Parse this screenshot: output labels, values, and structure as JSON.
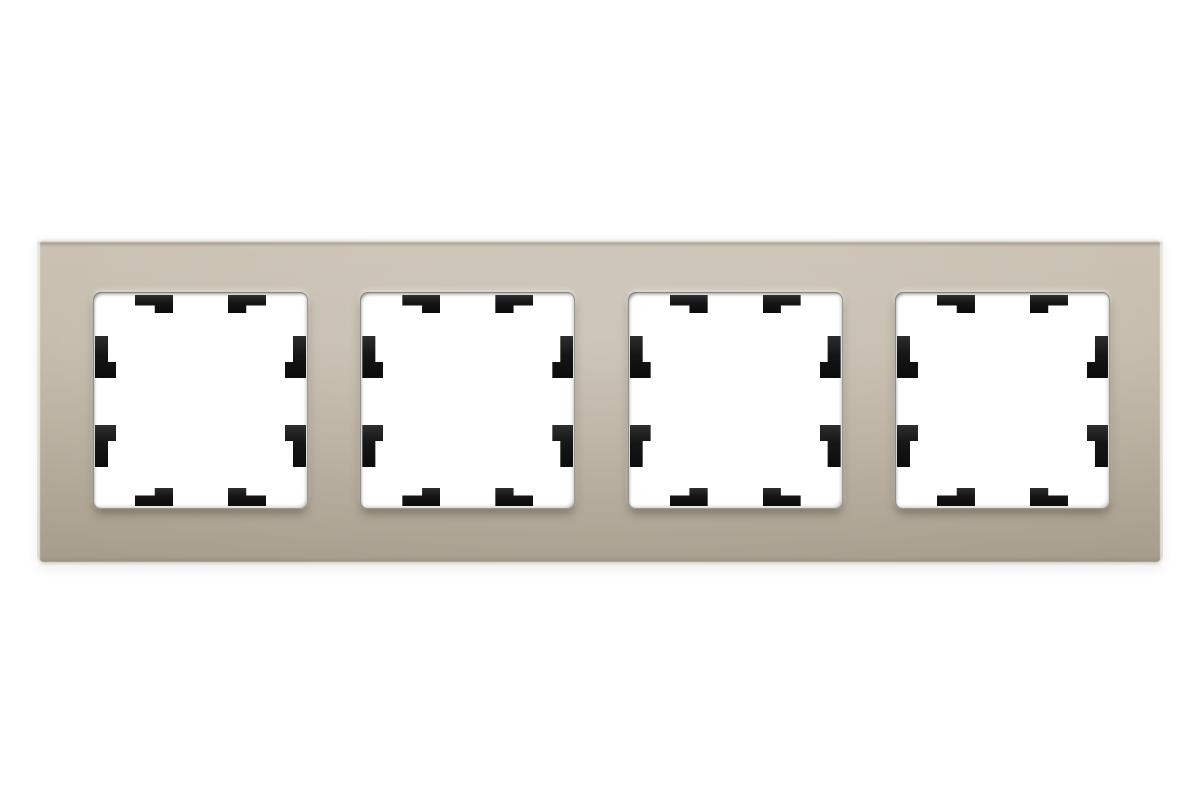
{
  "image": {
    "type": "product-photo",
    "description": "Four-gang horizontal glass wall-switch frame in champagne finish on a white background; each of the four square white module windows has eight black plastic retention clips on its edges",
    "background_color": "#ffffff"
  },
  "product": {
    "item": "4-gang switch/socket surround frame",
    "material": "glass",
    "finish_name": "champagne",
    "window_count": 4,
    "clips_per_window": 8,
    "clip_positions": [
      "top-left",
      "top-right",
      "left-upper",
      "left-lower",
      "right-upper",
      "right-lower",
      "bottom-left",
      "bottom-right"
    ]
  },
  "theme": {
    "background": "#ffffff",
    "frame-top": "#c9c0b1",
    "frame-bottom": "#a89e8e",
    "window-fill": "#ffffff",
    "clip-fill": "#151515"
  },
  "windows": [
    {
      "id": "window-1"
    },
    {
      "id": "window-2"
    },
    {
      "id": "window-3"
    },
    {
      "id": "window-4"
    }
  ]
}
